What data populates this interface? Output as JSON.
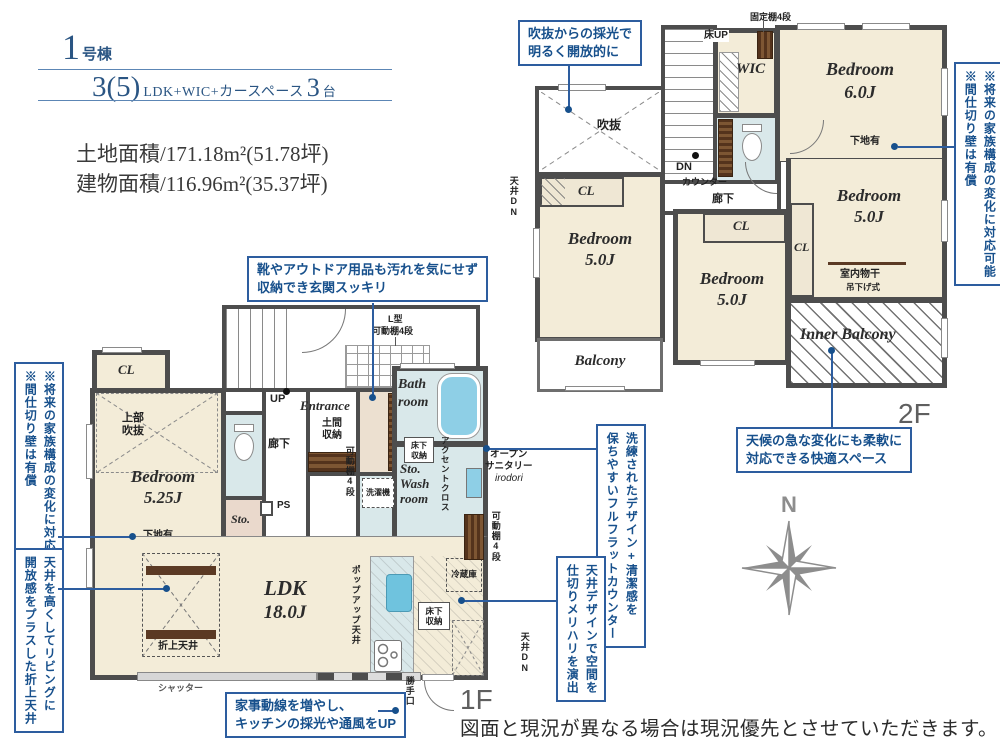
{
  "accent": "#17508c",
  "header": {
    "building_num": "1",
    "building_suffix": "号棟",
    "plan_num": "3(5)",
    "plan_text": "LDK+WIC+カースペース",
    "plan_num2": "3",
    "plan_suffix": "台",
    "land_area": "土地面積/171.18m²(51.78坪)",
    "building_area": "建物面積/116.96m²(35.37坪)"
  },
  "floor2": {
    "label": "2F",
    "void": "吹抜",
    "wic": "WIC",
    "fixed_shelf": "固定棚4段",
    "floor_up": "床UP",
    "dn": "DN",
    "counter": "カウンター",
    "hallway": "廊下",
    "ceiling_dn": "天井DN",
    "cl1": "CL",
    "cl2": "CL",
    "cl3": "CL",
    "bedroom1_name": "Bedroom",
    "bedroom1_size": "6.0J",
    "bedroom2_name": "Bedroom",
    "bedroom2_size": "5.0J",
    "bedroom3_name": "Bedroom",
    "bedroom3_size": "5.0J",
    "bedroom4_name": "Bedroom",
    "bedroom4_size": "5.0J",
    "shitaji": "下地有",
    "monohoshi": "室内物干",
    "tsurisage": "吊下げ式",
    "balcony": "Balcony",
    "inner_balcony": "Inner Balcony"
  },
  "floor1": {
    "label": "1F",
    "cl": "CL",
    "jobu1": "上部",
    "jobu2": "吹抜",
    "bedroom_name": "Bedroom",
    "bedroom_size": "5.25J",
    "shitaji": "下地有",
    "up": "UP",
    "hallway": "廊下",
    "ps": "PS",
    "sto": "Sto.",
    "entrance": "Entrance",
    "doma1": "土間",
    "doma2": "収納",
    "kadou_entrance": "可動棚4段",
    "lgata1": "L型",
    "lgata2": "可動棚4段",
    "bath1": "Bath",
    "bath2": "room",
    "yukashita_w1": "床下",
    "yukashita_w2": "収納",
    "wash1": "Sto.",
    "wash2": "Wash",
    "wash3": "room",
    "sentakuki": "洗濯機",
    "accent_cross": "アクセントクロス",
    "open1": "オープン",
    "open2": "サニタリー",
    "open3": "irodori",
    "kadou_kitchen": "可動棚4段",
    "reizouko": "冷蔵庫",
    "yukashita_k1": "床下",
    "yukashita_k2": "収納",
    "ceiling_dn": "天井DN",
    "katteguchi": "勝手口",
    "ldk_name": "LDK",
    "ldk_size": "18.0J",
    "oriage": "折上天井",
    "shutter": "シャッター",
    "popup": "ポップアップ天井"
  },
  "annotations": {
    "void_light1": "吹抜からの採光で",
    "void_light2": "明るく開放的に",
    "partition1": "※将来の家族構成の変化に対応可能",
    "partition2": "※間仕切り壁は有償",
    "weather1": "天候の急な変化にも柔軟に",
    "weather2": "対応できる快適スペース",
    "shoes1": "靴やアウトドア用品も汚れを気にせず",
    "shoes2": "収納でき玄関スッキリ",
    "ceiling_high1": "天井を高くしてリビングに",
    "ceiling_high2": "開放感をプラスした折上天井",
    "flat1": "洗練されたデザイン+清潔感を",
    "flat2": "保ちやすいフルフラットカウンター",
    "ceiling_design1": "天井デザインで空間を",
    "ceiling_design2": "仕切りメリハリを演出",
    "kaji1": "家事動線を増やし、",
    "kaji2": "キッチンの採光や通風をUP"
  },
  "compass_n": "N",
  "disclaimer": "図面と現況が異なる場合は現況優先とさせていただきます。"
}
